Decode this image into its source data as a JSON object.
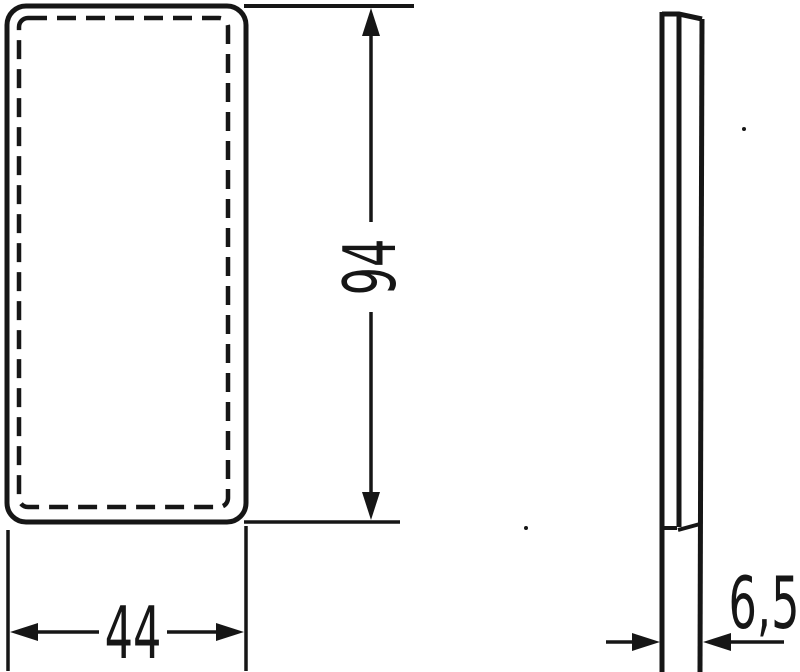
{
  "colors": {
    "ink": "#161616",
    "background": "#ffffff"
  },
  "drawing": {
    "type": "technical-dimension-drawing",
    "views": [
      "front-view",
      "side-profile-view"
    ],
    "dimensions": {
      "height": "94",
      "width": "44",
      "depth": "6,5"
    }
  }
}
